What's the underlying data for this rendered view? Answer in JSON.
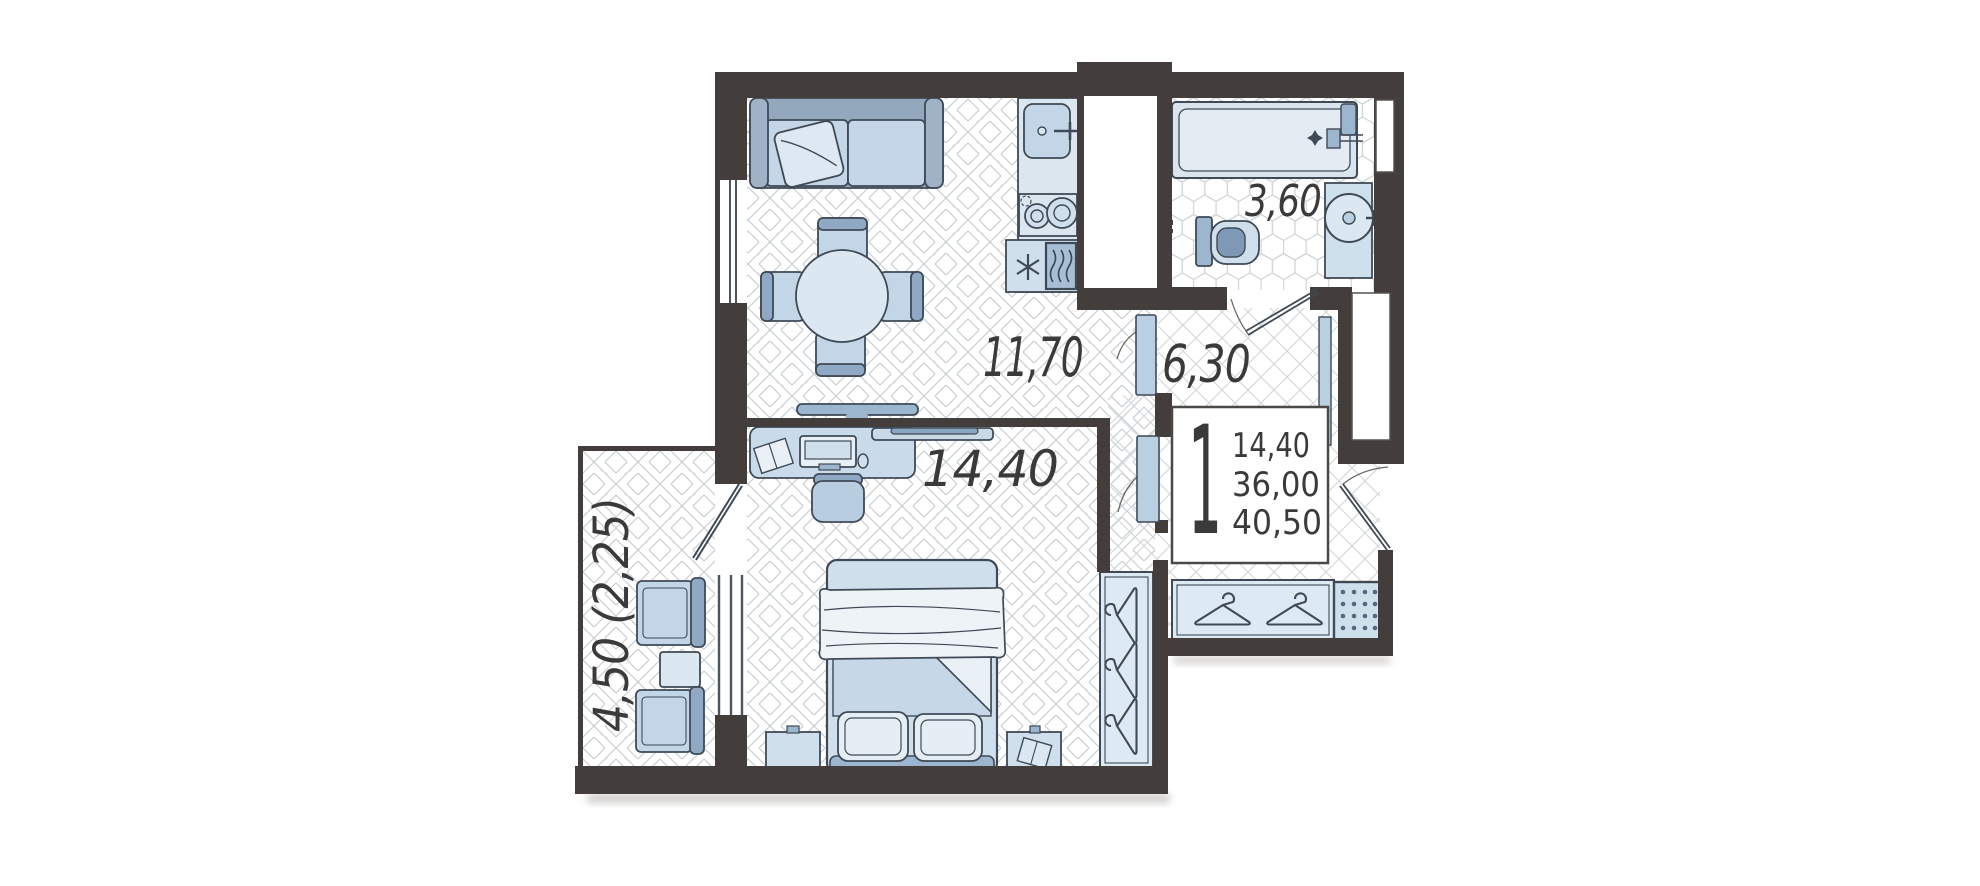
{
  "plan": {
    "kind": "apartment-floor-plan",
    "rooms": [
      {
        "id": "living-kitchen",
        "area": "11,70"
      },
      {
        "id": "hallway",
        "area": "6,30"
      },
      {
        "id": "bathroom",
        "area": "3,60"
      },
      {
        "id": "bedroom",
        "area": "14,40"
      },
      {
        "id": "balcony",
        "area": "4,50 (2,25)"
      }
    ],
    "info_box": {
      "rooms_count": "1",
      "living_area": "14,40",
      "area_wo_balcony": "36,00",
      "total_area": "40,50"
    },
    "colors": {
      "wall": "#433e3b",
      "furniture_light": "#c8d9e8",
      "furniture_mid": "#93a8bd",
      "furniture_pale": "#dfe9f2",
      "accent_dark_blue": "#7e99b5",
      "outline": "#3f4a56",
      "floor_line": "#cfd4d8",
      "label_text": "#3a3a3a"
    }
  }
}
